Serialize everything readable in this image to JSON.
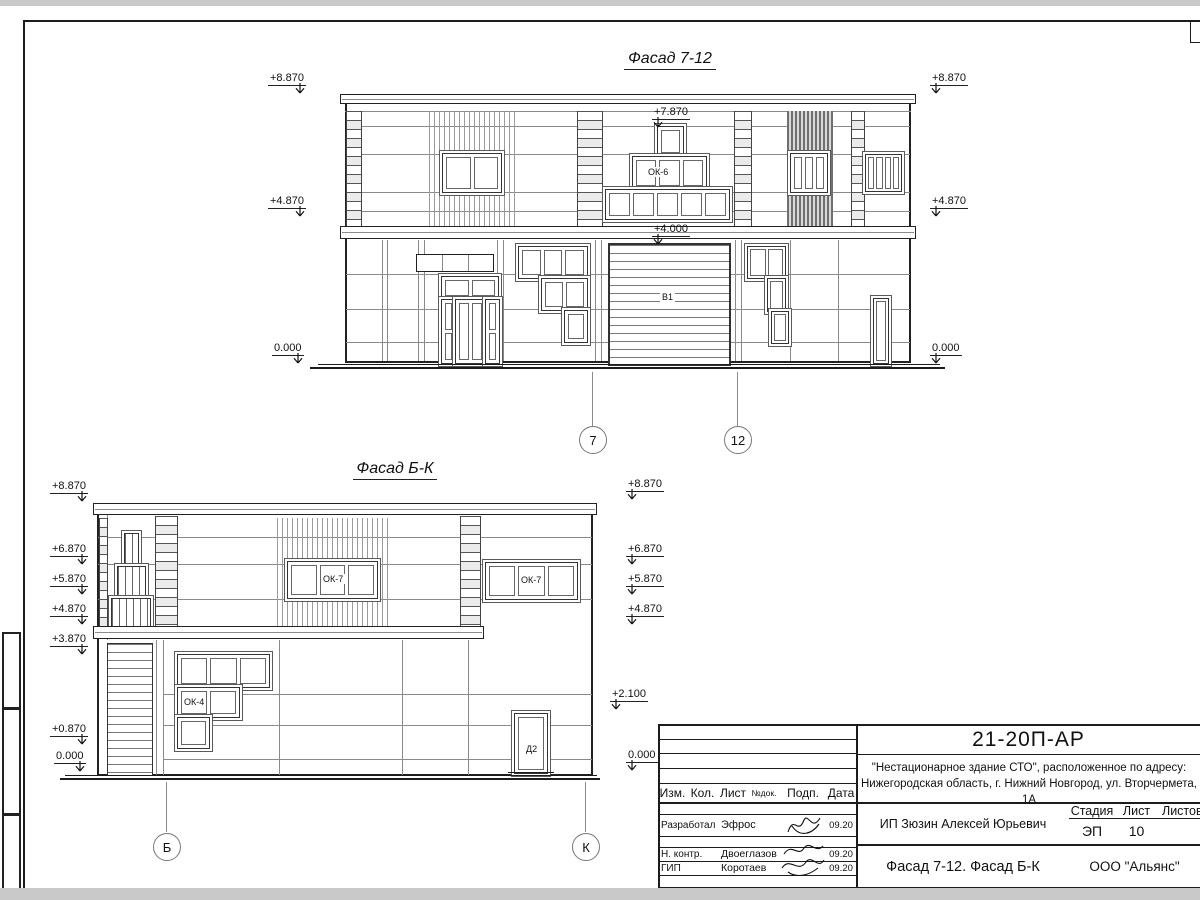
{
  "sheet": {
    "doc_number": "21-20П-АР",
    "project_line1": "\"Нестационарное здание СТО\", расположенное по адресу:",
    "project_line2": "Нижегородская область, г. Нижний Новгород, ул. Вторчермета, 1А",
    "client": "ИП Зюзин Алексей Юрьевич",
    "sheet_title": "Фасад 7-12. Фасад Б-К",
    "company": "ООО \"Альянс\"",
    "stage_label": "Стадия",
    "stage_value": "ЭП",
    "list_label": "Лист",
    "list_value": "10",
    "listov_label": "Листов",
    "rev_headers": {
      "izm": "Изм.",
      "kol": "Кол.",
      "list": "Лист",
      "ndoc": "№док.",
      "podp": "Подп.",
      "data": "Дата"
    },
    "signers": [
      {
        "role": "Разработал",
        "name": "Эфрос",
        "date": "09.20"
      },
      {
        "role": "Н. контр.",
        "name": "Двоеглазов",
        "date": "09.20"
      },
      {
        "role": "ГИП",
        "name": "Коротаев",
        "date": "09.20"
      }
    ]
  },
  "facade1": {
    "title": "Фасад 7-12",
    "marks": {
      "left": [
        "+8.870",
        "+4.870",
        "0.000"
      ],
      "right": [
        "+8.870",
        "+4.870",
        "0.000"
      ],
      "center": [
        "+7.870",
        "+4.000"
      ]
    },
    "labels": {
      "ok6": "ОК-6",
      "gate": "В1"
    },
    "axes": [
      "7",
      "12"
    ]
  },
  "facade2": {
    "title": "Фасад Б-К",
    "marks": {
      "left": [
        "+8.870",
        "+6.870",
        "+5.870",
        "+4.870",
        "+3.870",
        "+0.870",
        "0.000"
      ],
      "right": [
        "+8.870",
        "+6.870",
        "+5.870",
        "+4.870",
        "+2.100",
        "0.000"
      ]
    },
    "labels": {
      "ok7": "ОК-7",
      "ok4": "ОК-4",
      "door": "Д2"
    },
    "axes": [
      "Б",
      "К"
    ]
  }
}
